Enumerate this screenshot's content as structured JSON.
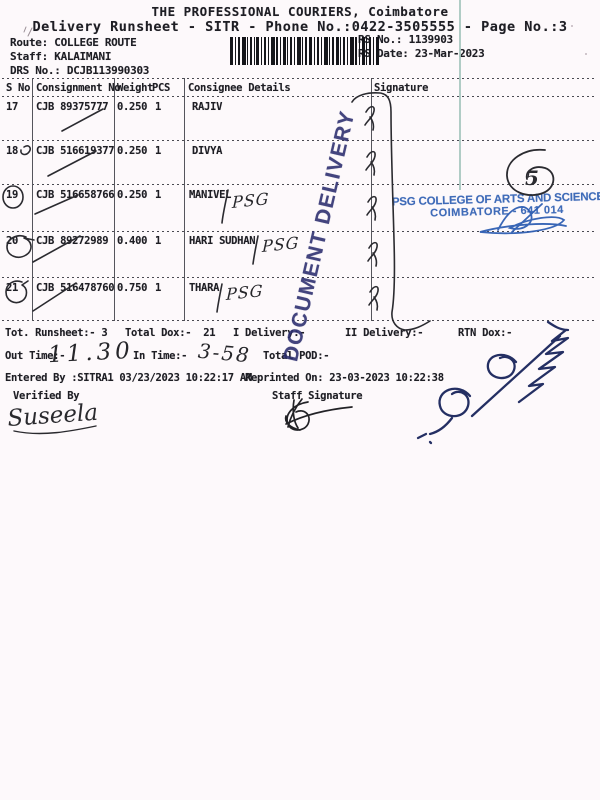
{
  "header": {
    "title": "THE PROFESSIONAL COURIERS, Coimbatore",
    "subtitle": "Delivery Runsheet - SITR - Phone No.:0422-3505555 - Page No.:3",
    "route": "Route: COLLEGE ROUTE",
    "staff": "Staff: KALAIMANI",
    "drs_no": "DRS No.: DCJB113990303",
    "rs_no": "RS No.: 1139903",
    "rs_date": "RS Date: 23-Mar-2023"
  },
  "table": {
    "headers": {
      "sno": "S No",
      "consignment": "Consignment No",
      "weight": "Weight",
      "pcs": "PCS",
      "consignee": "Consignee Details",
      "signature": "Signature"
    },
    "rows": [
      {
        "sno": "17",
        "consignment": "CJB 89375777",
        "weight": "0.250",
        "pcs": "1",
        "consignee": "RAJIV",
        "annotation": ""
      },
      {
        "sno": "18",
        "consignment": "CJB 516619377",
        "weight": "0.250",
        "pcs": "1",
        "consignee": "DIVYA",
        "annotation": ""
      },
      {
        "sno": "19",
        "consignment": "CJB 516658766",
        "weight": "0.250",
        "pcs": "1",
        "consignee": "MANIVEL",
        "annotation": "PSG"
      },
      {
        "sno": "20",
        "consignment": "CJB 89272989",
        "weight": "0.400",
        "pcs": "1",
        "consignee": "HARI SUDHAN",
        "annotation": "PSG"
      },
      {
        "sno": "21",
        "consignment": "CJB 516478760",
        "weight": "0.750",
        "pcs": "1",
        "consignee": "THARA",
        "annotation": "PSG"
      }
    ]
  },
  "summary": {
    "runsheet": "Tot. Runsheet:- 3",
    "total_dox": "Total Dox:-  21",
    "i_delivery": "I Delivery:-",
    "ii_delivery": "II Delivery:-",
    "rtn_dox": "RTN Dox:-",
    "out_time_label": "Out Time:-",
    "out_time_hw": "11.30",
    "in_time_label": "In Time:-",
    "in_time_hw": "3-58",
    "total_pod_label": "Total POD:-",
    "entered_by": "Entered By :SITRA1 03/23/2023 10:22:17 AM",
    "reprinted_on": "Reprinted On: 23-03-2023 10:22:38",
    "verified_by_label": "Verified By",
    "staff_signature_label": "Staff Signature",
    "verified_signature": "Suseela"
  },
  "stamps": {
    "document_delivery": "DOCUMENT DELIVERY",
    "college_line1": "PSG COLLEGE OF ARTS AND SCIENCE",
    "college_line2": "COIMBATORE - 641 014",
    "page_mark": "5"
  },
  "colors": {
    "stamp_navy": "#2a2c6d",
    "stamp_blue": "#2f5fb3",
    "pen_black": "#2b2b30",
    "ink_blue": "#242f63",
    "teal_artifact": "#a7c6bf",
    "paper": "#fdf9fb"
  }
}
